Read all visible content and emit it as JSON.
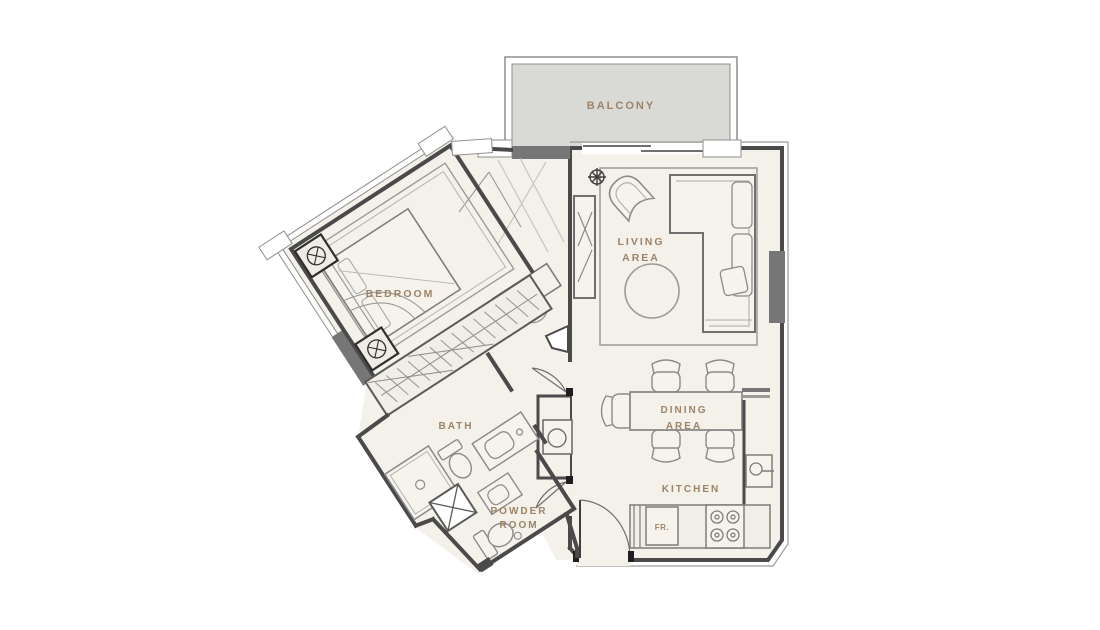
{
  "plan": {
    "title": "one-bedroom apartment floor plan",
    "labels": {
      "balcony": "BALCONY",
      "living_line1": "LIVING",
      "living_line2": "AREA",
      "bedroom": "BEDROOM",
      "bath": "BATH",
      "powder_line1": "POWDER",
      "powder_line2": "ROOM",
      "dining_line1": "DINING",
      "dining_line2": "AREA",
      "kitchen": "KITCHEN",
      "fridge": "FR."
    },
    "colors": {
      "label_text": "#9c8468",
      "wall": "#4a4a4a",
      "floor": "#f4f1ea",
      "balcony_fill": "#d9d9d6",
      "furniture_line": "#8b8b8b",
      "dark_block": "#767676"
    }
  }
}
